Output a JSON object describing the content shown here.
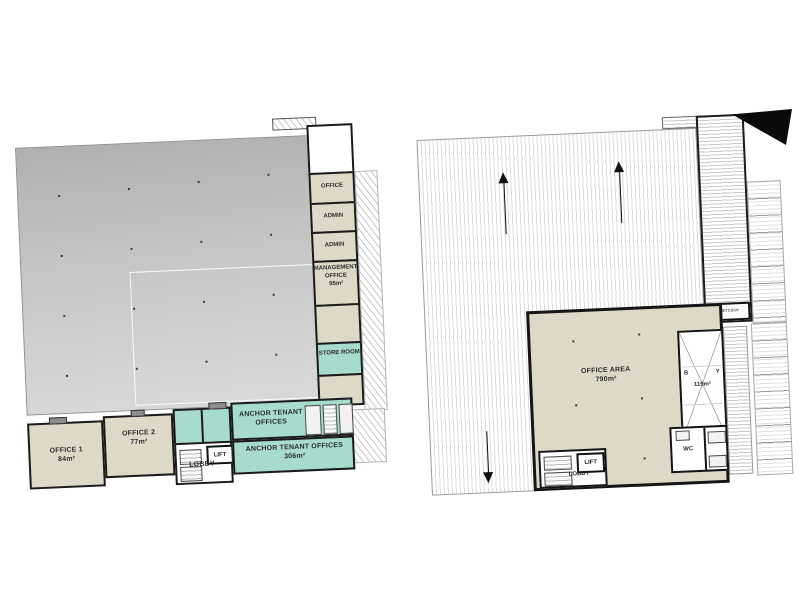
{
  "document": {
    "kind": "architectural floor plans, two storeys side by side",
    "background": "#ffffff"
  },
  "left_plan": {
    "name": "ground-floor-plan",
    "rooms": {
      "office1": {
        "name": "OFFICE 1",
        "area": "84m²"
      },
      "office2": {
        "name": "OFFICE 2",
        "area": "77m²"
      },
      "lobby": {
        "name": "LOBBY"
      },
      "lift": {
        "name": "LIFT"
      },
      "anchor_tenant_offices": {
        "name": "ANCHOR TENANT OFFICES"
      },
      "anchor_tenant_offices_main": {
        "name": "ANCHOR TENANT OFFICES",
        "area": "306m²"
      },
      "office": {
        "name": "OFFICE"
      },
      "admin_upper": {
        "name": "ADMIN"
      },
      "admin_lower": {
        "name": "ADMIN"
      },
      "management_office": {
        "name": "MANAGEMENT OFFICE",
        "area": "95m²"
      },
      "store_room": {
        "name": "STORE ROOM"
      }
    }
  },
  "right_plan": {
    "name": "first-floor-plan",
    "rooms": {
      "office_area": {
        "name": "OFFICE AREA",
        "area": "790m²"
      },
      "balcony": {
        "left_letter": "B",
        "right_letter": "Y",
        "area": "119m²"
      },
      "lobby": {
        "name": "LOBBY"
      },
      "lift": {
        "name": "LIFT"
      },
      "wc": {
        "name": "WC"
      },
      "staircase": {
        "name": "staircase"
      }
    }
  },
  "colors": {
    "tenant_teal": "#a6dbce",
    "office_beige": "#ded9c6",
    "warehouse_gray_top": "#b0b0b0",
    "warehouse_gray_bottom": "#dadada",
    "wall": "#1b1b1b"
  }
}
